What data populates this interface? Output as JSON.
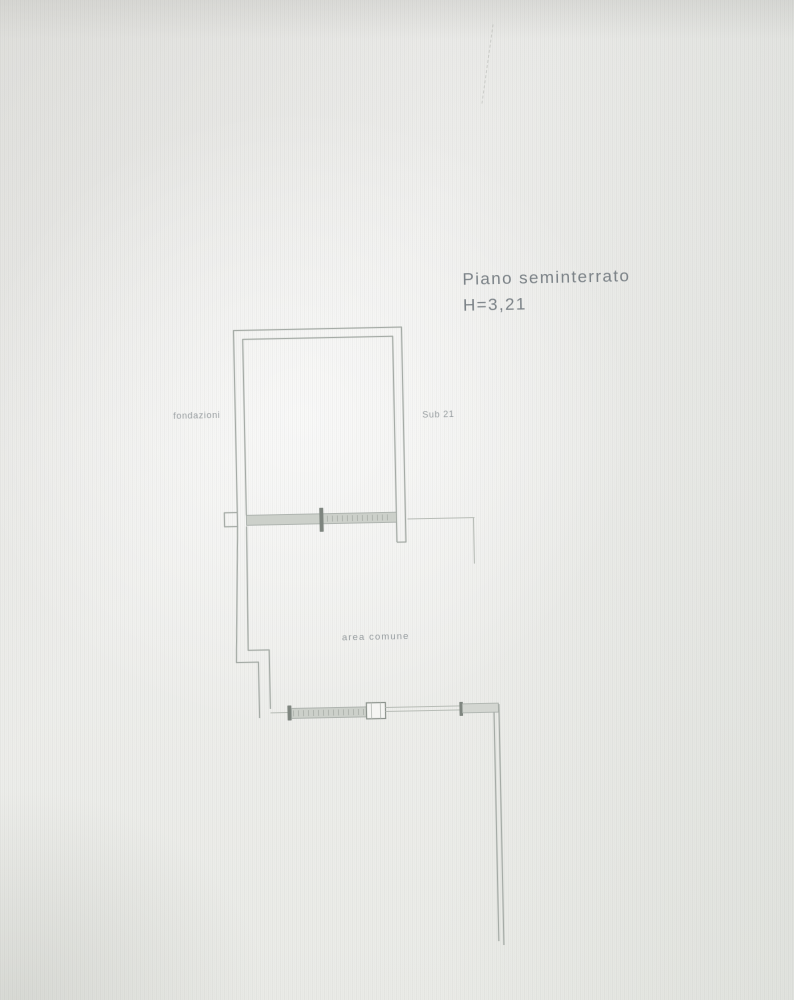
{
  "annotation": {
    "floor": "Piano seminterrato",
    "height": "H=3,21"
  },
  "labels": {
    "left": "fondazioni",
    "right": "Sub 21",
    "center": "area comune"
  },
  "colors": {
    "paper": "#eeeeec",
    "wall_line": "#a4aaa5",
    "wall_dark": "#7e857f",
    "wall_fill": "#ccd0ca",
    "annotation_text": "#7b8287",
    "small_label_text": "#979da0"
  }
}
